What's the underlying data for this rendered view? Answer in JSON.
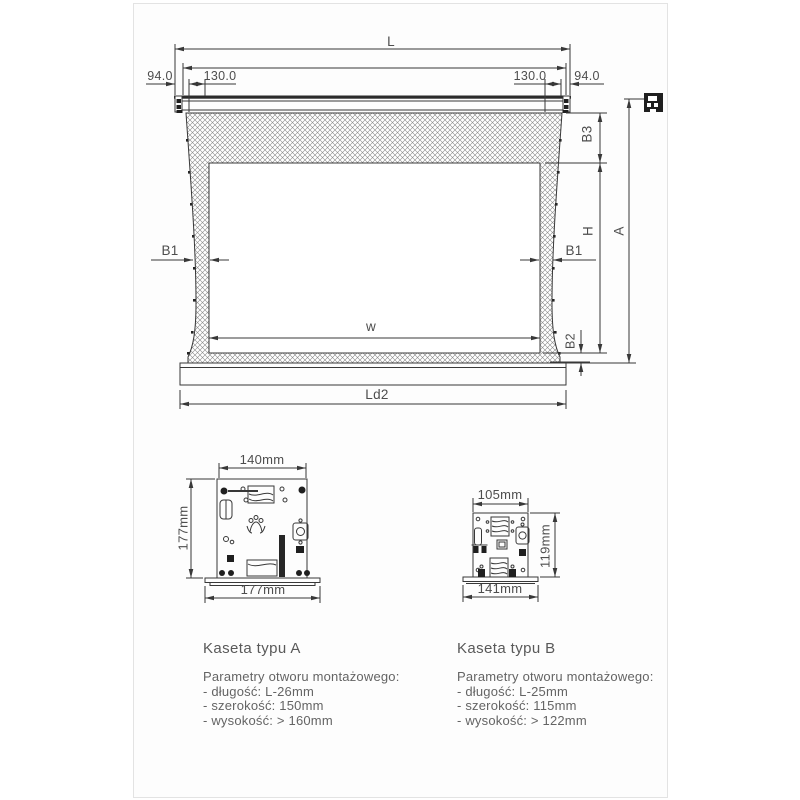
{
  "colors": {
    "line": "#383838",
    "dim_text": "#4d4d4d",
    "body_text": "#646464",
    "frame_border": "#e3e3e3",
    "hatch": "#8a8a8a"
  },
  "main_diagram": {
    "labels": {
      "total_width": "L",
      "offset_left": "94.0",
      "bracket_left": "130.0",
      "bracket_right": "130.0",
      "offset_right": "94.0",
      "top_border": "B3",
      "viewing_height": "H",
      "total_height": "A",
      "side_border_left": "B1",
      "side_border_right": "B1",
      "viewing_width": "w",
      "bottom_border": "B2",
      "slat_width": "Ld2"
    },
    "icons": {
      "profile": "cassette-side-profile-icon"
    }
  },
  "cassette_a": {
    "title": "Kaseta typu A",
    "dims": {
      "top": "140mm",
      "side": "177mm",
      "bottom": "177mm"
    },
    "params_heading": "Parametry otworu montażowego:",
    "params": [
      "- długość: L-26mm",
      "- szerokość: 150mm",
      "- wysokość: > 160mm"
    ]
  },
  "cassette_b": {
    "title": "Kaseta typu B",
    "dims": {
      "top": "105mm",
      "side": "119mm",
      "bottom": "141mm"
    },
    "params_heading": "Parametry otworu montażowego:",
    "params": [
      "- długość: L-25mm",
      "- szerokość: 115mm",
      "- wysokość: > 122mm"
    ]
  }
}
